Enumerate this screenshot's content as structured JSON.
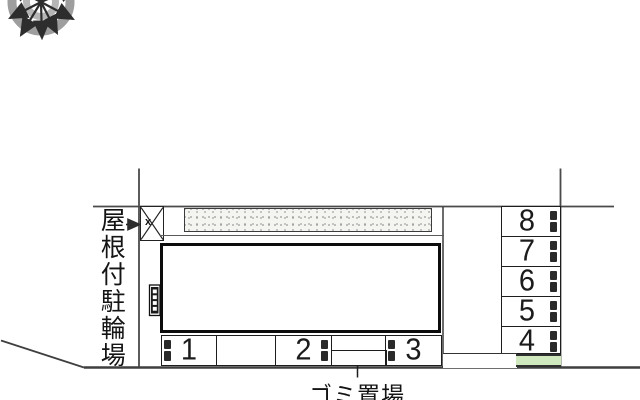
{
  "plan": {
    "bicycle_area": {
      "label": "屋根付駐輪場",
      "marker": "x"
    },
    "garbage_area": {
      "label": "ゴミ置場"
    },
    "bottom_spaces": [
      "1",
      "2",
      "3"
    ],
    "right_spaces": [
      "8",
      "7",
      "6",
      "5",
      "4"
    ],
    "icons": {
      "compass": "compass-rose-icon",
      "steps": "entrance-steps-icon",
      "bicycle_marker": "crossed-box-marker",
      "wheel_stop": "wheel-stop-marker"
    },
    "colors": {
      "line_dark": "#1d1d1d",
      "boundary_line": "#4a4a4a",
      "green_strip": "#cfe8bd",
      "stipple_base": "#f4f4f1",
      "stipple_dot": "#8f8f8f",
      "compass_outer_ring": "#9e9e9e",
      "compass_inner_ring": "#b6b6b6",
      "compass_arrow": "#2d2d2d"
    }
  }
}
